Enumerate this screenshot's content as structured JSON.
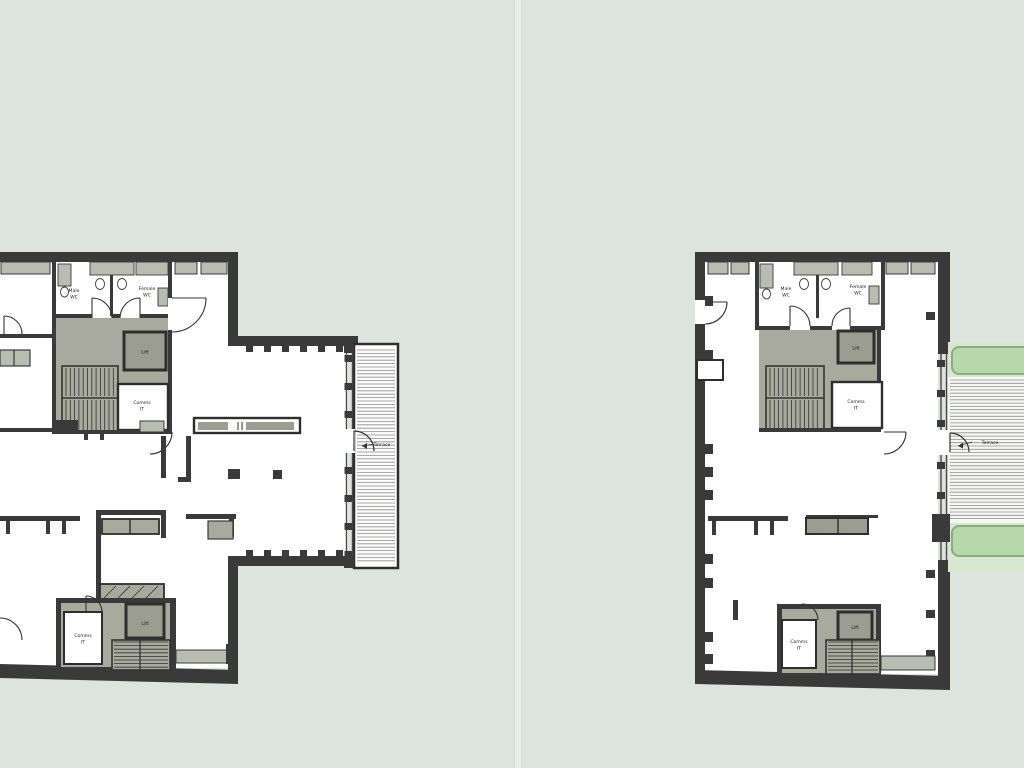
{
  "page": {
    "background_color": "#dce4dd",
    "divider_color": "#e9efe9",
    "content": "Two architectural floor plans side by side"
  },
  "colors": {
    "wall": "#3a3a3a",
    "core_fill": "#a7aa9d",
    "lift_fill": "#9a9d90",
    "sill_fill": "#b9bcb1",
    "floor": "#ffffff",
    "terrace_green": "#d7e7d0",
    "planter_fill": "#b7d8aa",
    "planter_border": "#8aac80",
    "deck_hatch": "#8f8f8f"
  },
  "plans": {
    "left": {
      "name": "left-floor-plan",
      "rooms": {
        "male_wc": {
          "line1": "Male",
          "line2": "WC"
        },
        "female_wc": {
          "line1": "Female",
          "line2": "WC"
        },
        "lift_upper": "Lift",
        "comms_upper": {
          "line1": "Comms",
          "line2": "IT"
        },
        "lift_lower": "Lift",
        "comms_lower": {
          "line1": "Comms",
          "line2": "IT"
        },
        "terrace": "Terrace"
      }
    },
    "right": {
      "name": "right-floor-plan",
      "rooms": {
        "male_wc": {
          "line1": "Male",
          "line2": "WC"
        },
        "female_wc": {
          "line1": "Female",
          "line2": "WC"
        },
        "lift_upper": "Lift",
        "comms_upper": {
          "line1": "Comms",
          "line2": "IT"
        },
        "lift_lower": "Lift",
        "comms_lower": {
          "line1": "Comms",
          "line2": "IT"
        },
        "terrace": "Terrace"
      }
    }
  }
}
